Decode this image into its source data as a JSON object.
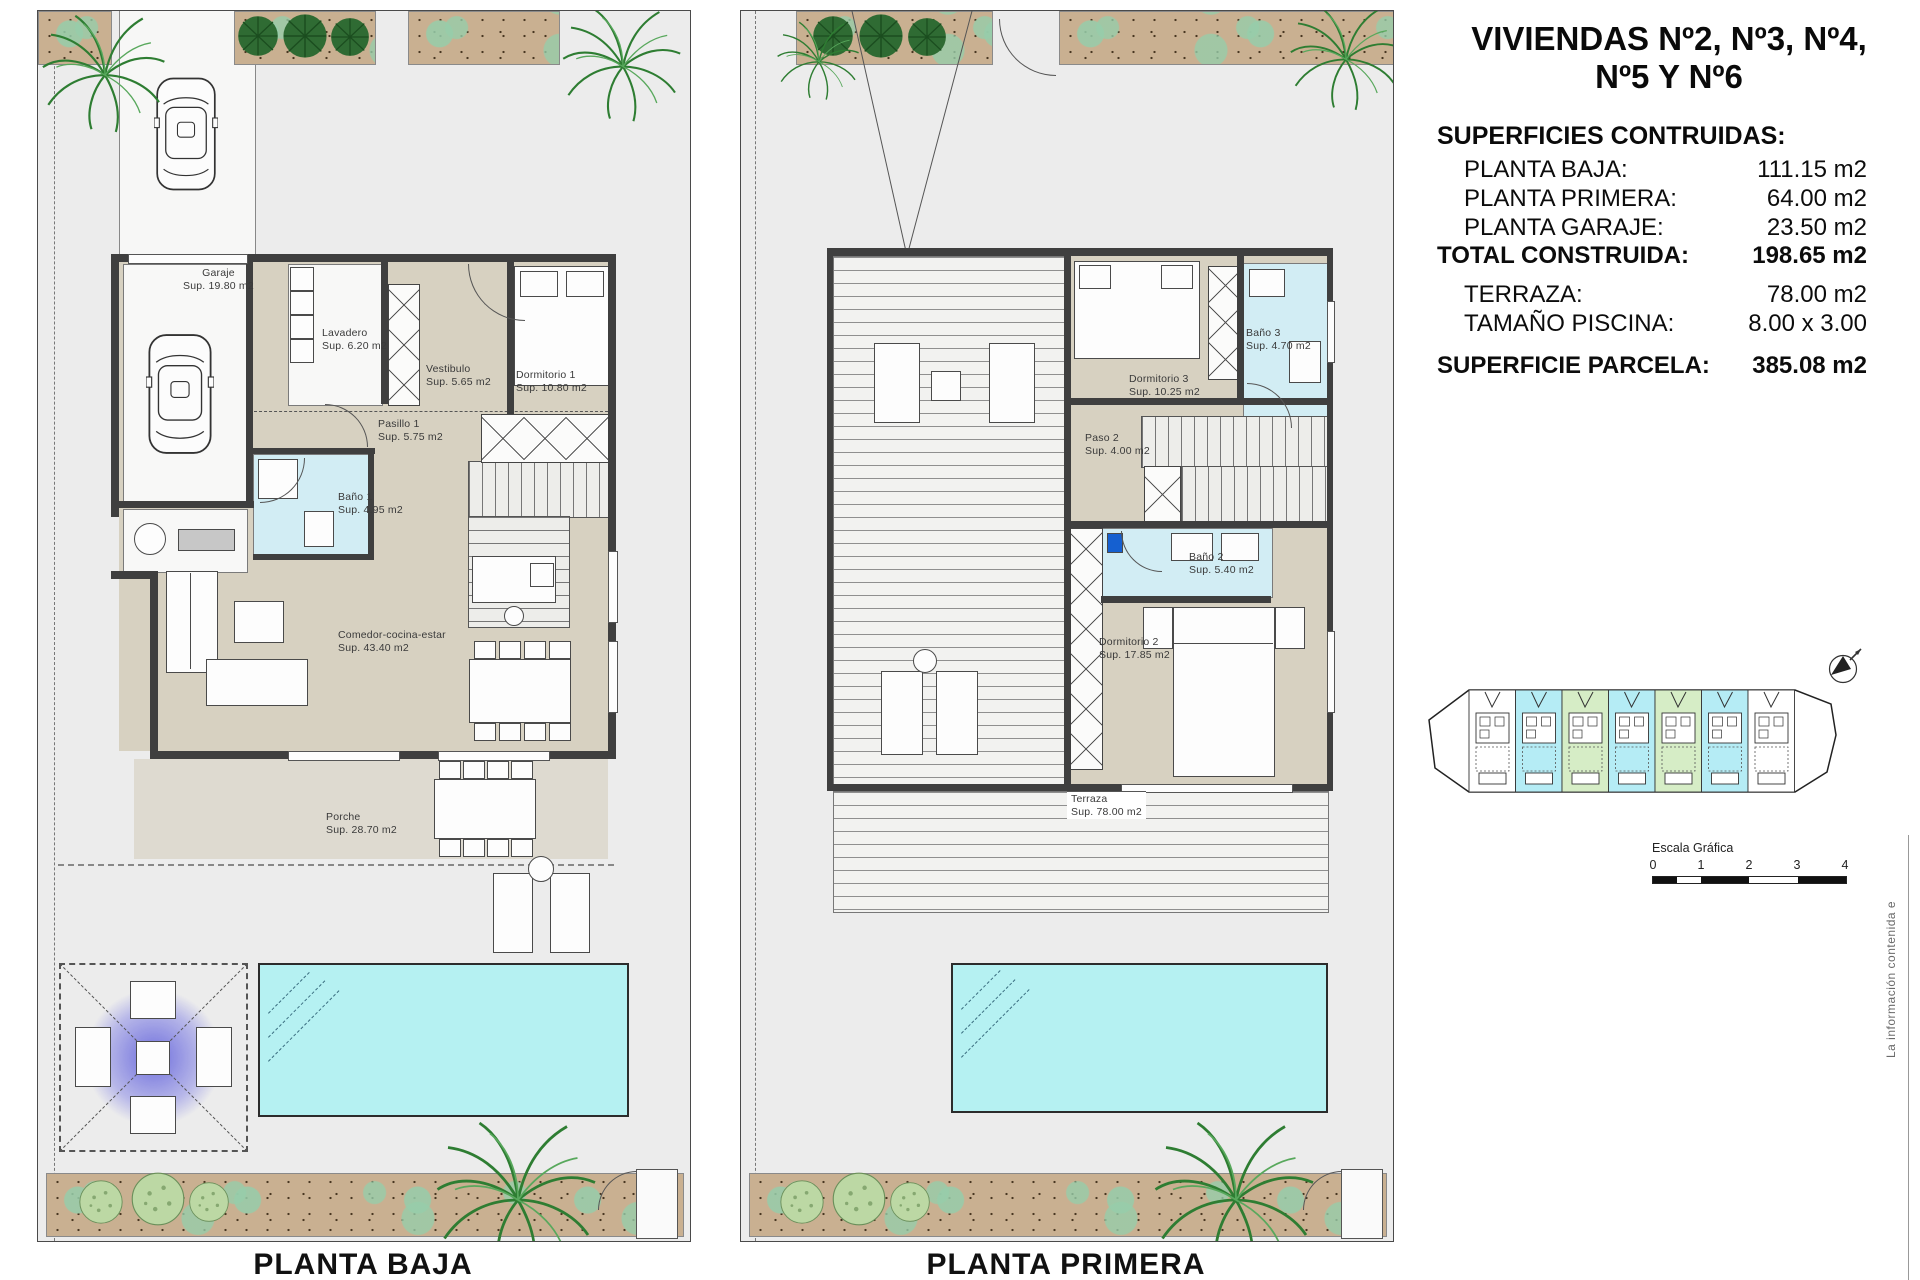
{
  "colors": {
    "plot_bg": "#ececec",
    "wall": "#3f3f3f",
    "floor_beige": "#d7d1c1",
    "floor_bath": "#d2edf4",
    "pool": "#b5f1f2",
    "garden_tan": "#c9b091",
    "pergola_glow": "#6a6ad8",
    "site_cyan": "#b5ecf5",
    "site_green": "#d6edc6"
  },
  "panel": {
    "title_line1": "VIVIENDAS Nº2, Nº3, Nº4,",
    "title_line2": "Nº5 Y Nº6",
    "surfaces_heading": "SUPERFICIES CONTRUIDAS:",
    "rows": [
      {
        "label": "PLANTA BAJA:",
        "value": "111.15 m2"
      },
      {
        "label": "PLANTA PRIMERA:",
        "value": "64.00 m2"
      },
      {
        "label": "PLANTA GARAJE:",
        "value": "23.50 m2"
      }
    ],
    "total_row": {
      "label": "TOTAL CONSTRUIDA:",
      "value": "198.65 m2"
    },
    "extra_rows": [
      {
        "label": "TERRAZA:",
        "value": "78.00 m2"
      },
      {
        "label": "TAMAÑO PISCINA:",
        "value": "8.00 x 3.00"
      }
    ],
    "parcel_row": {
      "label": "SUPERFICIE PARCELA:",
      "value": "385.08 m2"
    },
    "scale_bar": {
      "label": "Escala Gráfica",
      "ticks": [
        "0",
        "1",
        "2",
        "3",
        "4"
      ]
    },
    "side_note": "La información contenida e"
  },
  "plan_baja": {
    "title": "PLANTA BAJA",
    "rooms": {
      "garaje": {
        "name": "Garaje",
        "sup": "Sup. 19.80 m2"
      },
      "lavadero": {
        "name": "Lavadero",
        "sup": "Sup. 6.20 m2"
      },
      "vestibulo": {
        "name": "Vestibulo",
        "sup": "Sup. 5.65 m2"
      },
      "dormitorio1": {
        "name": "Dormitorio 1",
        "sup": "Sup. 10.80 m2"
      },
      "pasillo1": {
        "name": "Pasillo 1",
        "sup": "Sup. 5.75 m2"
      },
      "bano1": {
        "name": "Baño 1",
        "sup": "Sup. 4.95 m2"
      },
      "comedor": {
        "name": "Comedor-cocina-estar",
        "sup": "Sup. 43.40 m2"
      },
      "porche": {
        "name": "Porche",
        "sup": "Sup. 28.70 m2"
      }
    }
  },
  "plan_primera": {
    "title": "PLANTA PRIMERA",
    "rooms": {
      "dormitorio3": {
        "name": "Dormitorio 3",
        "sup": "Sup. 10.25 m2"
      },
      "bano3": {
        "name": "Baño 3",
        "sup": "Sup. 4.70 m2"
      },
      "paso2": {
        "name": "Paso 2",
        "sup": "Sup. 4.00 m2"
      },
      "bano2": {
        "name": "Baño 2",
        "sup": "Sup. 5.40 m2"
      },
      "dormitorio2": {
        "name": "Dormitorio 2",
        "sup": "Sup. 17.85 m2"
      },
      "terraza": {
        "name": "Terraza",
        "sup": "Sup. 78.00 m2"
      }
    }
  },
  "site_plan": {
    "colors": {
      "white": "#ffffff",
      "cyan": "#b5ecf5",
      "green": "#d6edc6"
    },
    "units": [
      "white",
      "cyan",
      "green",
      "cyan",
      "green",
      "cyan",
      "white"
    ]
  }
}
